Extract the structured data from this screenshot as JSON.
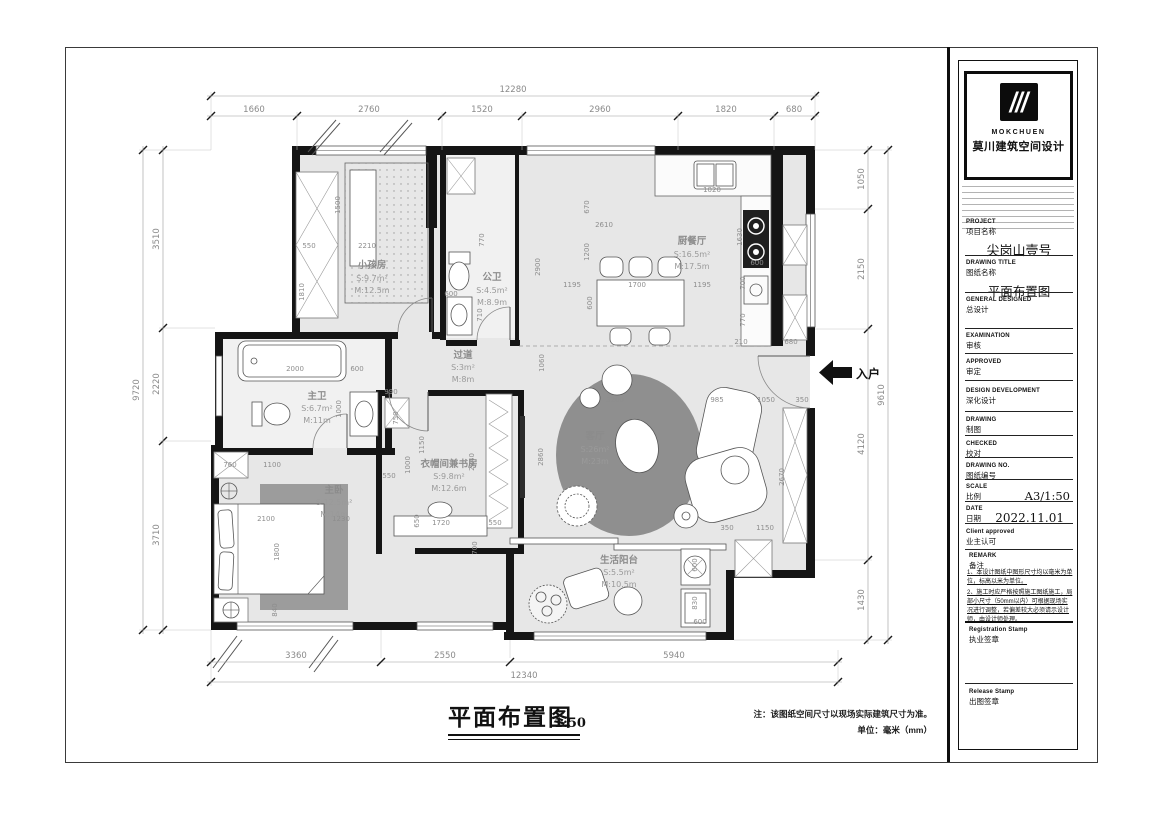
{
  "brand": {
    "logo_en": "MOKCHUEN",
    "logo_cn": "莫川建筑空间设计"
  },
  "titleblock": {
    "fields": [
      {
        "en": "PROJECT",
        "cn": "项目名称",
        "value": "尖岗山壹号"
      },
      {
        "en": "DRAWING TITLE",
        "cn": "图纸名称",
        "value": "平面布置图"
      },
      {
        "en": "GENERAL DESIGNED",
        "cn": "总设计",
        "value": ""
      },
      {
        "en": "EXAMINATION",
        "cn": "审核",
        "value": ""
      },
      {
        "en": "APPROVED",
        "cn": "审定",
        "value": ""
      },
      {
        "en": "DESIGN DEVELOPMENT",
        "cn": "深化设计",
        "value": ""
      },
      {
        "en": "DRAWING",
        "cn": "制图",
        "value": ""
      },
      {
        "en": "CHECKED",
        "cn": "校对",
        "value": ""
      },
      {
        "en": "DRAWING NO.",
        "cn": "图纸编号",
        "value": ""
      },
      {
        "en": "SCALE",
        "cn": "比例",
        "value": "A3/1:50"
      },
      {
        "en": "DATE",
        "cn": "日期",
        "value": "2022.11.01"
      },
      {
        "en": "Client approved",
        "cn": "业主认可",
        "value": ""
      }
    ],
    "remark": {
      "en": "REMARK",
      "cn": "备注",
      "notes": [
        "1、本设计图纸中图形尺寸均以毫米为单位，标高以米为单位。",
        "2、施工时应严格按照施工图纸施工，局部小尺寸（50mm以内）可根据现场实况进行调整，若偏差较大必须请示设计师，由设计师处理。"
      ]
    },
    "reg_stamp": {
      "en": "Registration Stamp",
      "cn": "执业签章"
    },
    "rel_stamp": {
      "en": "Release Stamp",
      "cn": "出图签章"
    }
  },
  "footer": {
    "title": "平面布置图",
    "scale": "1:50",
    "note": "注：该图纸空间尺寸以现场实际建筑尺寸为准。",
    "unit": "单位：毫米（mm）"
  },
  "plan": {
    "entry": "入户",
    "rooms": [
      {
        "name": "小孩房",
        "s": "S:9.7m²",
        "m": "M:12.5m"
      },
      {
        "name": "公卫",
        "s": "S:4.5m²",
        "m": "M:8.9m"
      },
      {
        "name": "厨餐厅",
        "s": "S:16.5m²",
        "m": "M:17.5m"
      },
      {
        "name": "过道",
        "s": "S:3m²",
        "m": "M:8m"
      },
      {
        "name": "主卫",
        "s": "S:6.7m²",
        "m": "M:11m"
      },
      {
        "name": "客厅",
        "s": "S:26m²",
        "m": "M:23m"
      },
      {
        "name": "衣帽间兼书房",
        "s": "S:9.8m²",
        "m": "M:12.6m"
      },
      {
        "name": "主卧",
        "s": "S:12.5m²",
        "m": "M:14m"
      },
      {
        "name": "生活阳台",
        "s": "S:5.5m²",
        "m": "M:10.5m"
      }
    ],
    "dims": {
      "top_total": "12280",
      "top": [
        "1660",
        "2760",
        "1520",
        "2960",
        "1820",
        "680"
      ],
      "left_total": "9720",
      "left": [
        "3510",
        "2220",
        "3710"
      ],
      "right_total": "9610",
      "right": [
        "1050",
        "2150",
        "4120",
        "1430"
      ],
      "bottom_total": "12340",
      "bottom": [
        "3360",
        "2550",
        "5940"
      ],
      "inner": [
        "550",
        "2210",
        "1810",
        "1500",
        "770",
        "600",
        "710",
        "2000",
        "600",
        "1000",
        "990",
        "750",
        "760",
        "1100",
        "2100",
        "1800",
        "1230",
        "840",
        "550",
        "1150",
        "1000",
        "650",
        "1720",
        "550",
        "2840",
        "700",
        "2860",
        "1060",
        "3200",
        "985",
        "1050",
        "350",
        "2670",
        "350",
        "1150",
        "600",
        "830",
        "2610",
        "670",
        "1200",
        "2900",
        "1195",
        "1700",
        "1195",
        "600",
        "1630",
        "1020",
        "600",
        "700",
        "770",
        "210",
        "680",
        "600"
      ]
    }
  }
}
